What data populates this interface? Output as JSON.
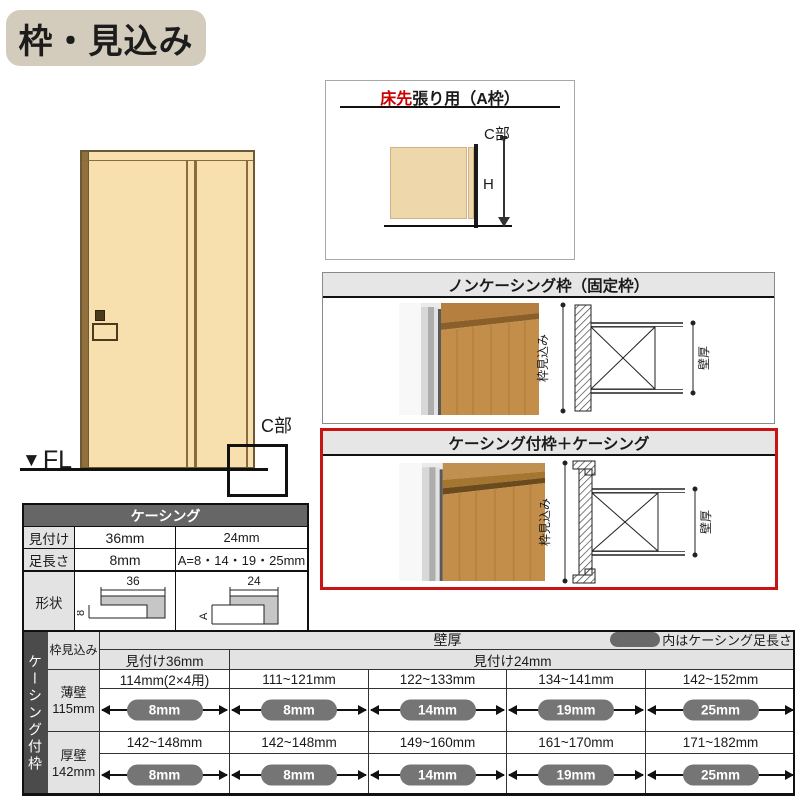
{
  "title_badge": {
    "label": "枠・見込み"
  },
  "door_figure": {
    "fl_triangle": "▼",
    "fl_label": "FL",
    "c_part_label": "C部"
  },
  "a_frame_box": {
    "title_highlight": "床先",
    "title_rest": "張り用（A枠）",
    "c_part_label": "C部",
    "height_label": "H"
  },
  "noncasing_box": {
    "title": "ノンケーシング枠（固定枠）",
    "frame_depth_label": "枠見込み",
    "wall_thickness_label": "壁厚"
  },
  "casing_box": {
    "title": "ケーシング付枠＋ケーシング",
    "frame_depth_label": "枠見込み",
    "wall_thickness_label": "壁厚"
  },
  "casing_spec_table": {
    "title": "ケーシング",
    "row_mitsuke": {
      "label": "見付け",
      "w36": "36mm",
      "w24": "24mm"
    },
    "row_ashinagasa": {
      "label": "足長さ",
      "w36": "8mm",
      "w24": "A=8・14・19・25mm"
    },
    "row_keijo": {
      "label": "形状"
    },
    "shape36": {
      "top_dim": "36",
      "leg_dim": "8"
    },
    "shape24": {
      "top_dim": "24",
      "leg_dim": "A"
    }
  },
  "wall_table": {
    "side_label": "ケーシング付枠",
    "corner_header": "枠見込み",
    "wall_header": "壁厚",
    "legend_label": "内はケーシング足長さ",
    "header_36": "見付け36mm",
    "header_24": "見付け24mm",
    "rows": [
      {
        "wall_type": "薄壁",
        "wall_size": "115mm",
        "cells": [
          {
            "range": "114mm(2×4用)",
            "leg": "8mm"
          },
          {
            "range": "111~121mm",
            "leg": "8mm"
          },
          {
            "range": "122~133mm",
            "leg": "14mm"
          },
          {
            "range": "134~141mm",
            "leg": "19mm"
          },
          {
            "range": "142~152mm",
            "leg": "25mm"
          }
        ]
      },
      {
        "wall_type": "厚壁",
        "wall_size": "142mm",
        "cells": [
          {
            "range": "142~148mm",
            "leg": "8mm"
          },
          {
            "range": "142~148mm",
            "leg": "8mm"
          },
          {
            "range": "149~160mm",
            "leg": "14mm"
          },
          {
            "range": "161~170mm",
            "leg": "19mm"
          },
          {
            "range": "171~182mm",
            "leg": "25mm"
          }
        ]
      }
    ]
  },
  "colors": {
    "accent_red": "#c91414",
    "badge_bg": "#d3ccbd",
    "door_fill": "#f7dfae",
    "header_gray": "#e6e6e6",
    "dark_gray": "#4b4b4b",
    "pill_gray": "#757575"
  }
}
